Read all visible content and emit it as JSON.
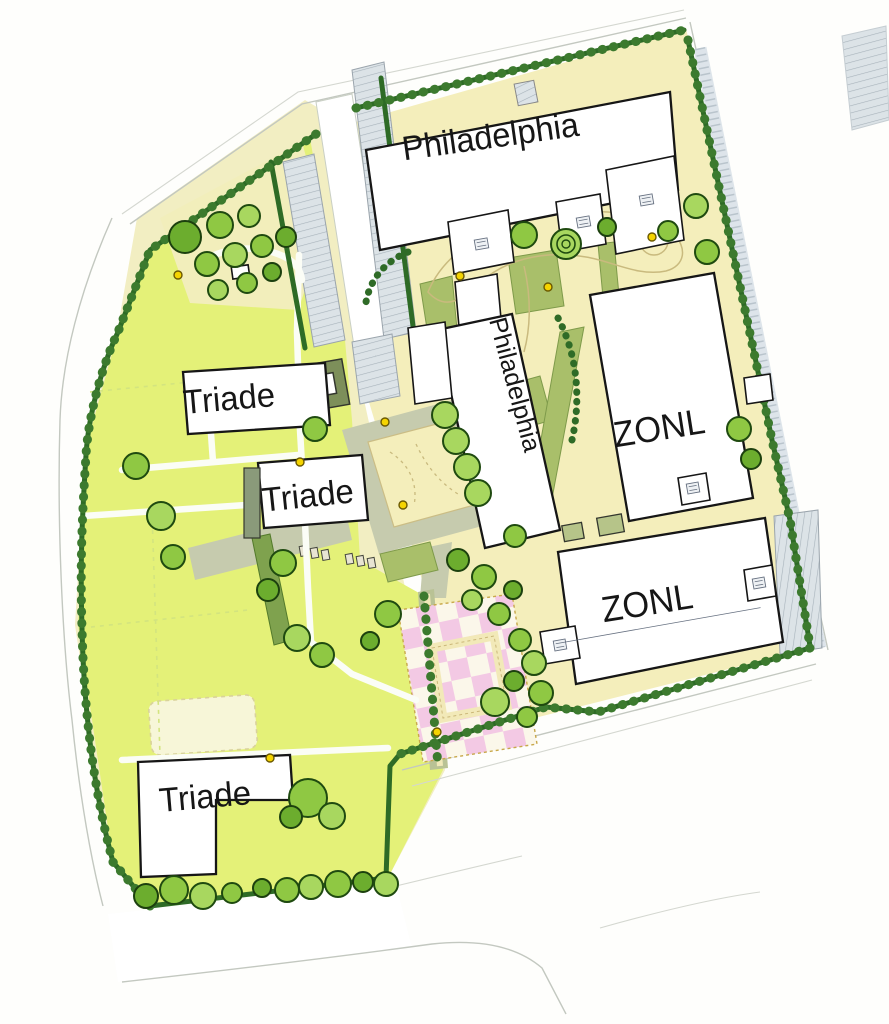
{
  "map": {
    "type": "landscape-site-plan",
    "labels": {
      "philadelphia_top": "Philadelphia",
      "philadelphia_mid": "Philadelphia",
      "zonl_upper": "ZONL",
      "zonl_lower": "ZONL",
      "triade_upper": "Triade",
      "triade_mid": "Triade",
      "triade_bottom": "Triade"
    },
    "palette": {
      "lawn": "#e4f178",
      "sand": "#f4eebb",
      "hedge": "#2e6b26",
      "tree_light": "#8fc843",
      "tree_dark": "#6cad2e",
      "plaza": "#c6cbae",
      "pink": "#f3c9e4",
      "checker_cream": "#fbf7ea",
      "building": "#ffffff",
      "outline": "#161616",
      "paving": "#dde4ea",
      "lamp": "#f5d400"
    }
  }
}
